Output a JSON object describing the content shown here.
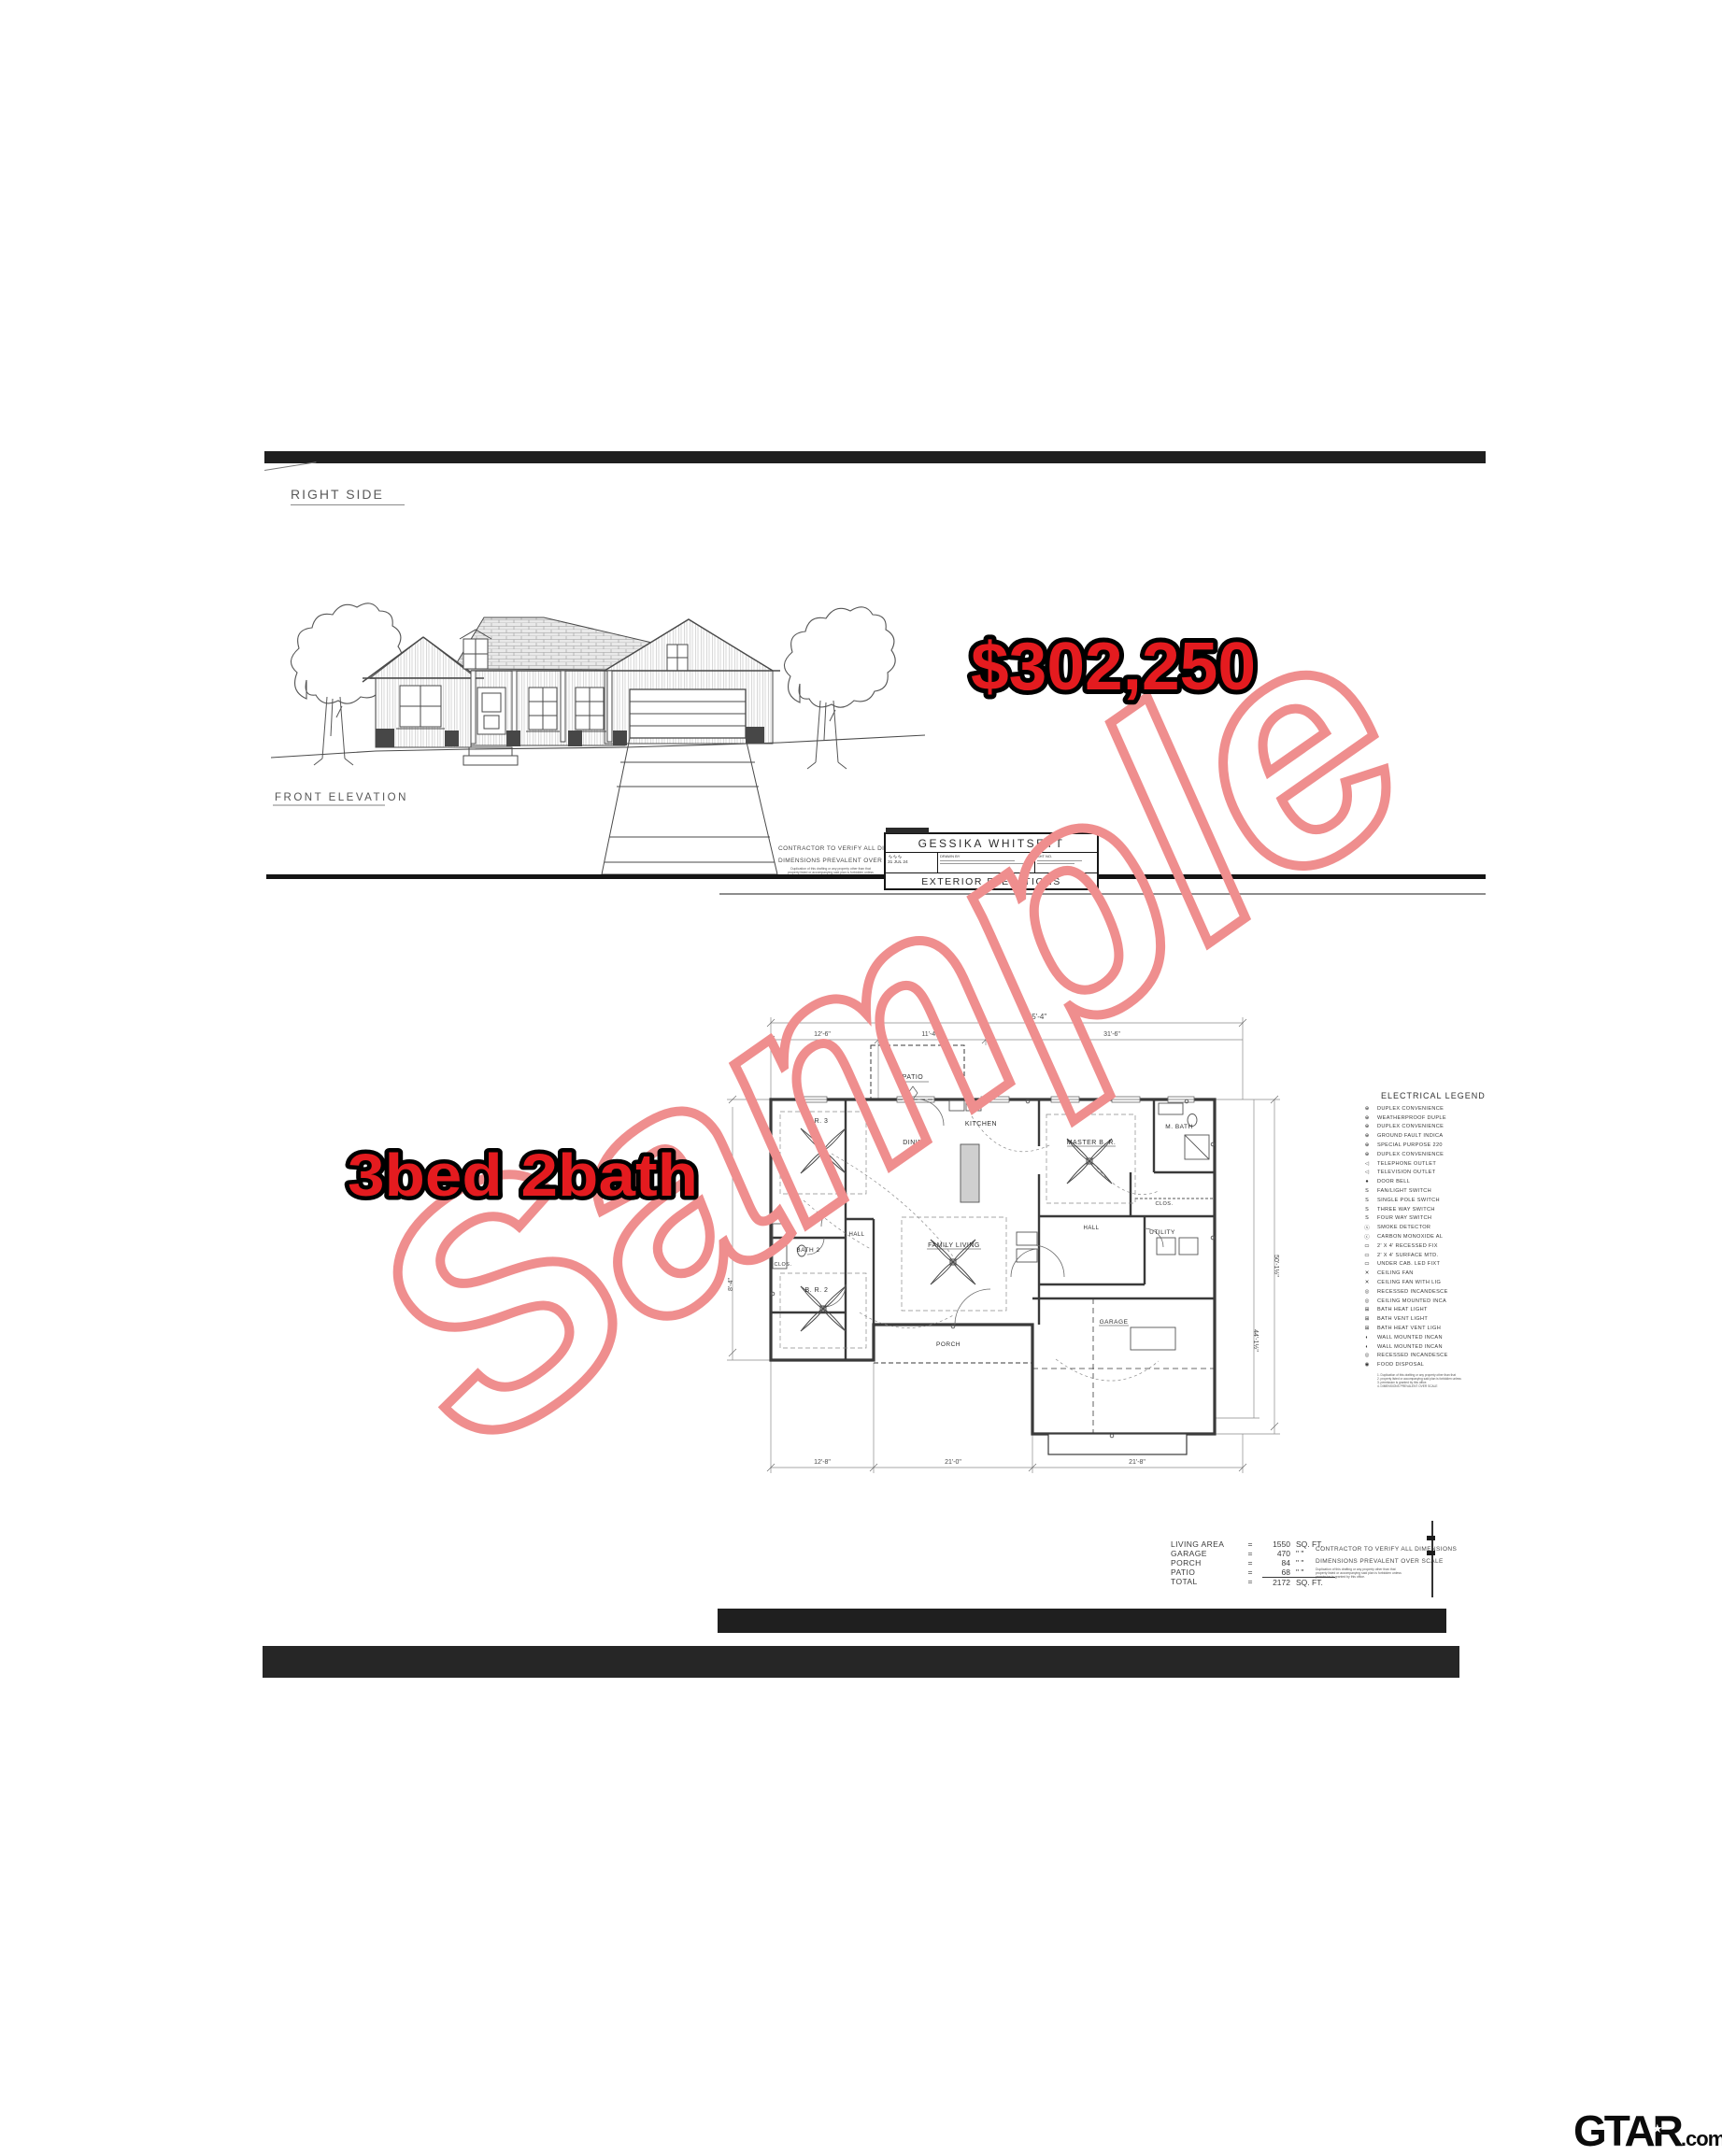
{
  "page": {
    "bg": "#ffffff"
  },
  "header": {
    "right_side_label": "RIGHT SIDE",
    "front_elevation_label": "FRONT ELEVATION"
  },
  "stamps": {
    "price": "$302,250",
    "beds": "3bed 2bath",
    "fill": "#e41b1f",
    "outline": "#000000"
  },
  "watermark": {
    "text": "Sample",
    "color": "#ef8e8e"
  },
  "title_block": {
    "owner": "GESSIKA WHITSETT",
    "sheet_title": "EXTERIOR ELEVATIONS",
    "date": "31 JUL 24",
    "drawn_by_label": "DRAWN BY",
    "sheet_no_label": "SHT NO."
  },
  "notes": {
    "verify": "CONTRACTOR TO VERIFY ALL DIMENSIONS",
    "prevail": "DIMENSIONS PREVALENT OVER SCALE",
    "disclaimer1": "Duplication of this drafting or any property other than that",
    "disclaimer2": "property listed or accompanying said plan is forbidden unless",
    "disclaimer3": "permission is granted by this office."
  },
  "floor_plan": {
    "rooms": {
      "patio": "PATIO",
      "kitchen": "KITCHEN",
      "dining": "DINING",
      "master": "MASTER B. R.",
      "mbath": "M. BATH",
      "br3": "B. R. 3",
      "br2": "B. R. 2",
      "bath2": "BATH 2",
      "hall": "HALL",
      "hall2": "HALL",
      "clos1": "CLOS.",
      "clos2": "CLOS.",
      "family": "FAMILY LIVING",
      "utility": "UTILITY",
      "porch": "PORCH",
      "garage": "GARAGE"
    },
    "dims": {
      "total_width": "55'-4\"",
      "w1": "12'-6\"",
      "w2": "11'-4\"",
      "w3": "31'-6\"",
      "b1": "12'-8\"",
      "b2": "21'-0\"",
      "b3": "21'-8\"",
      "left": "8'-4\"",
      "right": "50'-1½\"",
      "right2": "44'-1½\""
    }
  },
  "legend": {
    "title": "ELECTRICAL LEGEND",
    "items": [
      "DUPLEX CONVENIENCE",
      "WEATHERPROOF DUPLE",
      "DUPLEX CONVENIENCE",
      "GROUND FAULT INDICA",
      "SPECIAL PURPOSE 220",
      "DUPLEX CONVENIENCE",
      "TELEPHONE OUTLET",
      "TELEVISION OUTLET",
      "DOOR BELL",
      "FAN/LIGHT SWITCH",
      "SINGLE POLE SWITCH",
      "THREE WAY SWITCH",
      "FOUR WAY SWITCH",
      "SMOKE DETECTOR",
      "CARBON MONOXIDE AL",
      "2' X 4' RECESSED FIX",
      "2' X 4' SURFACE MTD.",
      "UNDER CAB. LED FIXT",
      "CEILING FAN",
      "CEILING FAN WITH LIG",
      "RECESSED INCANDESCE",
      "CEILING MOUNTED INCA",
      "BATH HEAT LIGHT",
      "BATH VENT LIGHT",
      "BATH HEAT VENT LIGH",
      "WALL MOUNTED INCAN",
      "WALL MOUNTED INCAN",
      "RECESSED INCANDESCE",
      "FOOD DISPOSAL"
    ],
    "symbols": [
      "⊕",
      "⊕",
      "⊕",
      "⊕",
      "⊕",
      "⊕",
      "◁",
      "◁",
      "●",
      "S",
      "S",
      "S",
      "S",
      "ⓢ",
      "ⓒ",
      "▭",
      "▭",
      "▭",
      "✕",
      "✕",
      "◎",
      "◎",
      "⊞",
      "⊞",
      "⊞",
      "◐",
      "◐",
      "◎",
      "◉"
    ]
  },
  "area_table": {
    "rows": [
      {
        "label": "LIVING AREA",
        "eq": "=",
        "value": "1550",
        "unit": "SQ. FT."
      },
      {
        "label": "GARAGE",
        "eq": "=",
        "value": "470",
        "unit": "\"  \""
      },
      {
        "label": "PORCH",
        "eq": "=",
        "value": "84",
        "unit": "\"  \""
      },
      {
        "label": "PATIO",
        "eq": "=",
        "value": "68",
        "unit": "\"  \""
      },
      {
        "label": "TOTAL",
        "eq": "=",
        "value": "2172",
        "unit": "SQ. FT."
      }
    ]
  },
  "footer_logo": {
    "brand": "GTAR",
    "star": "★",
    "suffix": ".com"
  }
}
